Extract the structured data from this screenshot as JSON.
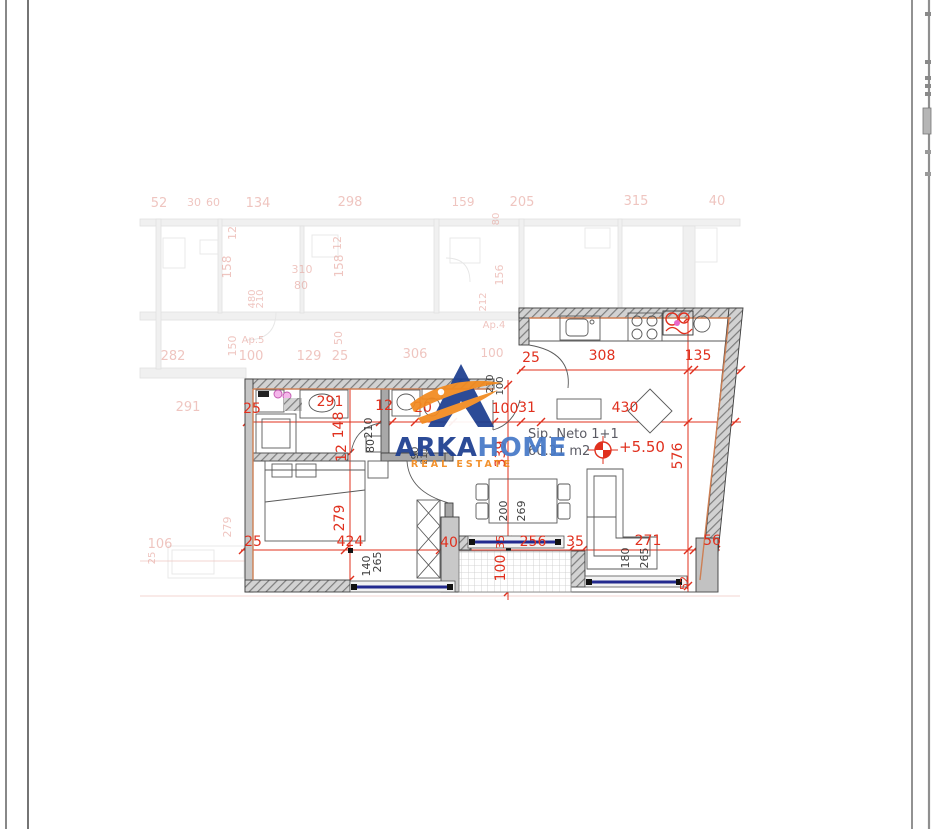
{
  "logo": {
    "arka": "ARKA",
    "home": "HOME",
    "tagline": "REAL ESTATE"
  },
  "unit": {
    "title": "Sip. Neto 1+1",
    "area": "60.31 m2",
    "level": "+5.50"
  },
  "colors": {
    "dim_red": "#e0301e",
    "dim_faded": "#e2968d",
    "label_dark": "#3f3f3f",
    "unit_text": "#5b5b64",
    "window_navy": "#232a8f",
    "logo_blue_dark": "#1c3e90",
    "logo_blue_light": "#4679c8",
    "logo_orange": "#f28a1f",
    "accent_orange": "#cd7f54",
    "highlight_pink": "#e966c9"
  },
  "dims_main": [
    {
      "t": "25",
      "x": 531,
      "y": 362
    },
    {
      "t": "308",
      "x": 602,
      "y": 360
    },
    {
      "t": "135",
      "x": 698,
      "y": 360
    },
    {
      "t": "25",
      "x": 252,
      "y": 413
    },
    {
      "t": "291",
      "x": 330,
      "y": 406
    },
    {
      "t": "12",
      "x": 384,
      "y": 410
    },
    {
      "t": "20",
      "x": 423,
      "y": 412
    },
    {
      "t": "100",
      "x": 505,
      "y": 413
    },
    {
      "t": "31",
      "x": 527,
      "y": 412
    },
    {
      "t": "430",
      "x": 625,
      "y": 412
    },
    {
      "t": "148",
      "x": 343,
      "y": 425,
      "r": -90
    },
    {
      "t": "12",
      "x": 346,
      "y": 453,
      "r": -90
    },
    {
      "t": "279",
      "x": 344,
      "y": 518,
      "r": -90
    },
    {
      "t": "339",
      "x": 505,
      "y": 454,
      "r": -90
    },
    {
      "t": "100",
      "x": 505,
      "y": 568,
      "r": -90
    },
    {
      "t": "576",
      "x": 682,
      "y": 456,
      "r": -90
    },
    {
      "t": "25",
      "x": 253,
      "y": 546
    },
    {
      "t": "424",
      "x": 350,
      "y": 546
    },
    {
      "t": "40",
      "x": 449,
      "y": 547
    },
    {
      "t": "35",
      "x": 504,
      "y": 542,
      "r": -90,
      "s": 11
    },
    {
      "t": "256",
      "x": 533,
      "y": 546
    },
    {
      "t": "35",
      "x": 575,
      "y": 546
    },
    {
      "t": "271",
      "x": 648,
      "y": 545
    },
    {
      "t": "56",
      "x": 712,
      "y": 545
    },
    {
      "t": "52",
      "x": 688,
      "y": 583,
      "r": -90,
      "s": 11
    }
  ],
  "labels_dark": [
    {
      "t": "210",
      "x": 372,
      "y": 428,
      "r": -90
    },
    {
      "t": "80",
      "x": 374,
      "y": 446,
      "r": -90
    },
    {
      "t": "210",
      "x": 493,
      "y": 384,
      "r": -90,
      "s": 10
    },
    {
      "t": "100",
      "x": 503,
      "y": 386,
      "r": -90,
      "s": 10
    },
    {
      "t": "90",
      "x": 418,
      "y": 453,
      "r": -90,
      "s": 10
    },
    {
      "t": "211",
      "x": 427,
      "y": 456,
      "r": -90,
      "s": 9
    },
    {
      "t": "140",
      "x": 370,
      "y": 566,
      "r": -90
    },
    {
      "t": "265",
      "x": 381,
      "y": 562,
      "r": -90
    },
    {
      "t": "200",
      "x": 507,
      "y": 511,
      "r": -90
    },
    {
      "t": "269",
      "x": 525,
      "y": 511,
      "r": -90
    },
    {
      "t": "180",
      "x": 629,
      "y": 558,
      "r": -90
    },
    {
      "t": "265",
      "x": 648,
      "y": 558,
      "r": -90
    }
  ],
  "dims_faded": [
    {
      "t": "52",
      "x": 159,
      "y": 207
    },
    {
      "t": "30",
      "x": 194,
      "y": 206,
      "s": 11
    },
    {
      "t": "60",
      "x": 213,
      "y": 206,
      "s": 11
    },
    {
      "t": "134",
      "x": 258,
      "y": 207
    },
    {
      "t": "298",
      "x": 350,
      "y": 206
    },
    {
      "t": "159",
      "x": 463,
      "y": 206,
      "s": 12
    },
    {
      "t": "205",
      "x": 522,
      "y": 206
    },
    {
      "t": "315",
      "x": 636,
      "y": 205
    },
    {
      "t": "40",
      "x": 717,
      "y": 205
    },
    {
      "t": "12",
      "x": 236,
      "y": 233,
      "r": -90,
      "s": 11
    },
    {
      "t": "158",
      "x": 231,
      "y": 267,
      "r": -90,
      "s": 12
    },
    {
      "t": "12",
      "x": 341,
      "y": 243,
      "r": -90,
      "s": 11
    },
    {
      "t": "158",
      "x": 343,
      "y": 266,
      "r": -90,
      "s": 12
    },
    {
      "t": "310",
      "x": 302,
      "y": 273,
      "s": 11
    },
    {
      "t": "80",
      "x": 301,
      "y": 289,
      "s": 11
    },
    {
      "t": "480",
      "x": 255,
      "y": 299,
      "r": -90,
      "s": 10
    },
    {
      "t": "210",
      "x": 263,
      "y": 299,
      "r": -90,
      "s": 10
    },
    {
      "t": "50",
      "x": 342,
      "y": 338,
      "r": -90,
      "s": 11
    },
    {
      "t": "150",
      "x": 236,
      "y": 346,
      "r": -90,
      "s": 11
    },
    {
      "t": "Ap.5",
      "x": 253,
      "y": 343,
      "s": 10
    },
    {
      "t": "Ap.4",
      "x": 494,
      "y": 328,
      "s": 10
    },
    {
      "t": "282",
      "x": 173,
      "y": 360
    },
    {
      "t": "100",
      "x": 251,
      "y": 360
    },
    {
      "t": "129",
      "x": 309,
      "y": 360
    },
    {
      "t": "25",
      "x": 340,
      "y": 360
    },
    {
      "t": "306",
      "x": 415,
      "y": 358
    },
    {
      "t": "100",
      "x": 492,
      "y": 357,
      "s": 12
    },
    {
      "t": "156",
      "x": 503,
      "y": 275,
      "r": -90,
      "s": 11
    },
    {
      "t": "212",
      "x": 486,
      "y": 302,
      "r": -90,
      "s": 10
    },
    {
      "t": "80",
      "x": 499,
      "y": 219,
      "r": -90,
      "s": 10
    },
    {
      "t": "291",
      "x": 188,
      "y": 411
    },
    {
      "t": "106",
      "x": 160,
      "y": 548
    },
    {
      "t": "25",
      "x": 155,
      "y": 558,
      "r": -90,
      "s": 10
    },
    {
      "t": "279",
      "x": 231,
      "y": 527,
      "r": -90,
      "s": 11
    }
  ]
}
